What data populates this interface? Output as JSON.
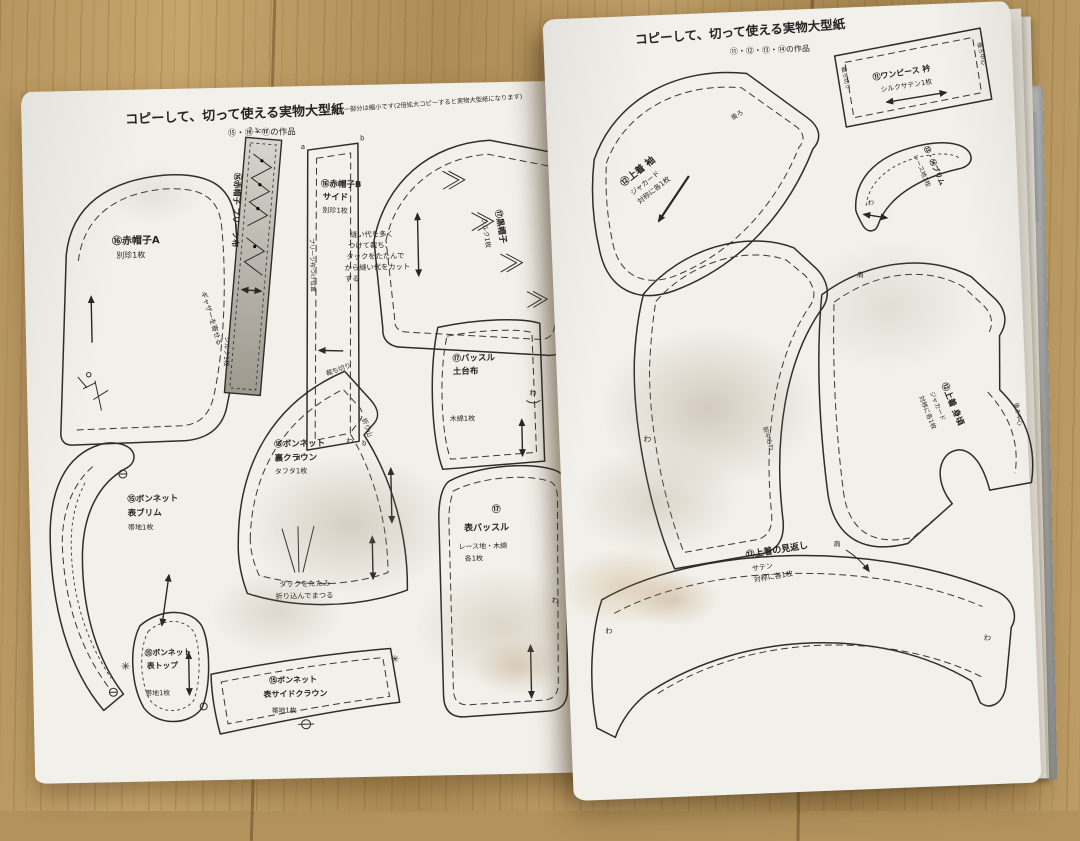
{
  "left_page": {
    "title": "コピーして、切って使える実物大型紙",
    "works": "⑮・⑯・⑰の作品",
    "scale_note": "グレー部分は縮小です(2倍拡大コピーすると実物大型紙になります)",
    "pieces": {
      "red_hat_a": {
        "name": "⑯赤帽子A",
        "fabric": "別珍1枚",
        "gather_mark": "ギャザーを寄せる"
      },
      "pleats_strip": {
        "name": "⑯赤帽子 プリーツ布",
        "fabric": "シルク1枚",
        "width": "2.3cm"
      },
      "red_hat_b": {
        "name": "⑯赤帽子B",
        "part": "サイド",
        "fabric": "別珍1枚",
        "placement": "プリーツ布つけ位置",
        "c1": "a",
        "c2": "b",
        "c3": "d",
        "c4": "b"
      },
      "black_hat": {
        "name": "⑰黒帽子",
        "fabric": "シルク1枚",
        "c1": "a",
        "c2": "d",
        "c3": "b",
        "note": [
          "縫い代を多く",
          "つけて裁ち、",
          "タックをたたんで",
          "から縫い代をカット",
          "する"
        ]
      },
      "bustle_base": {
        "name": "⑰バッスル",
        "part": "土台布",
        "fabric": "木綿1枚",
        "fold": "わ"
      },
      "bonnet_front_brim": {
        "name": "⑮ボンネット",
        "part": "表ブリム",
        "fabric": "帯地1枚"
      },
      "bonnet_back_crown": {
        "name": "⑮ボンネット",
        "part": "裏クラウン",
        "fabric": "タフタ1枚",
        "cut_mark": "裁ち切り",
        "fold_mark": "折り山",
        "fold": "わ",
        "tuck_note": [
          "タックをたたみ",
          "折り込んでまつる"
        ]
      },
      "bonnet_top": {
        "name": "⑮ボンネット",
        "part": "表トップ",
        "fabric": "帯地1枚",
        "star": "✳"
      },
      "bonnet_side_crown": {
        "name": "⑮ボンネット",
        "part": "表サイドクラウン",
        "fabric": "帯地1枚",
        "star": "✳"
      },
      "front_bustle": {
        "num": "⑰",
        "name": "表バッスル",
        "fabric1": "レース地・木綿",
        "fabric2": "各1枚",
        "fold": "わ"
      }
    }
  },
  "right_page": {
    "title": "コピーして、切って使える実物大型紙",
    "works": "⑪・⑫・⑬・⑭の作品",
    "pieces": {
      "jacket_sleeve": {
        "name": "⑫上着 袖",
        "fabric": "ジャカード",
        "cut": "対称に各1枚",
        "back_mark": "後ろ"
      },
      "dress_collar": {
        "name": "⑪ワンピース 衿",
        "fabric": "シルクサテン1枚",
        "left_mark": "裁ち切り",
        "right_mark": "後ろ中心"
      },
      "brim": {
        "name": "⑬・⑭ブリム",
        "fabric": "レース地1枚",
        "fold": "わ"
      },
      "dress_skirt": {
        "fold": "わ",
        "center_mark": "前中心わ"
      },
      "jacket_bodice": {
        "name": "⑫上着 身頃",
        "fabric": "ジャカード",
        "cut": "対称に各1枚",
        "shoulder": "肩",
        "center_back": "後ろ中心"
      },
      "jacket_facing": {
        "name": "⑫上着の見返し",
        "fabric": "サテン",
        "cut": "対称に各1枚",
        "shoulder": "肩",
        "fold1": "わ",
        "fold2": "わ"
      }
    }
  }
}
